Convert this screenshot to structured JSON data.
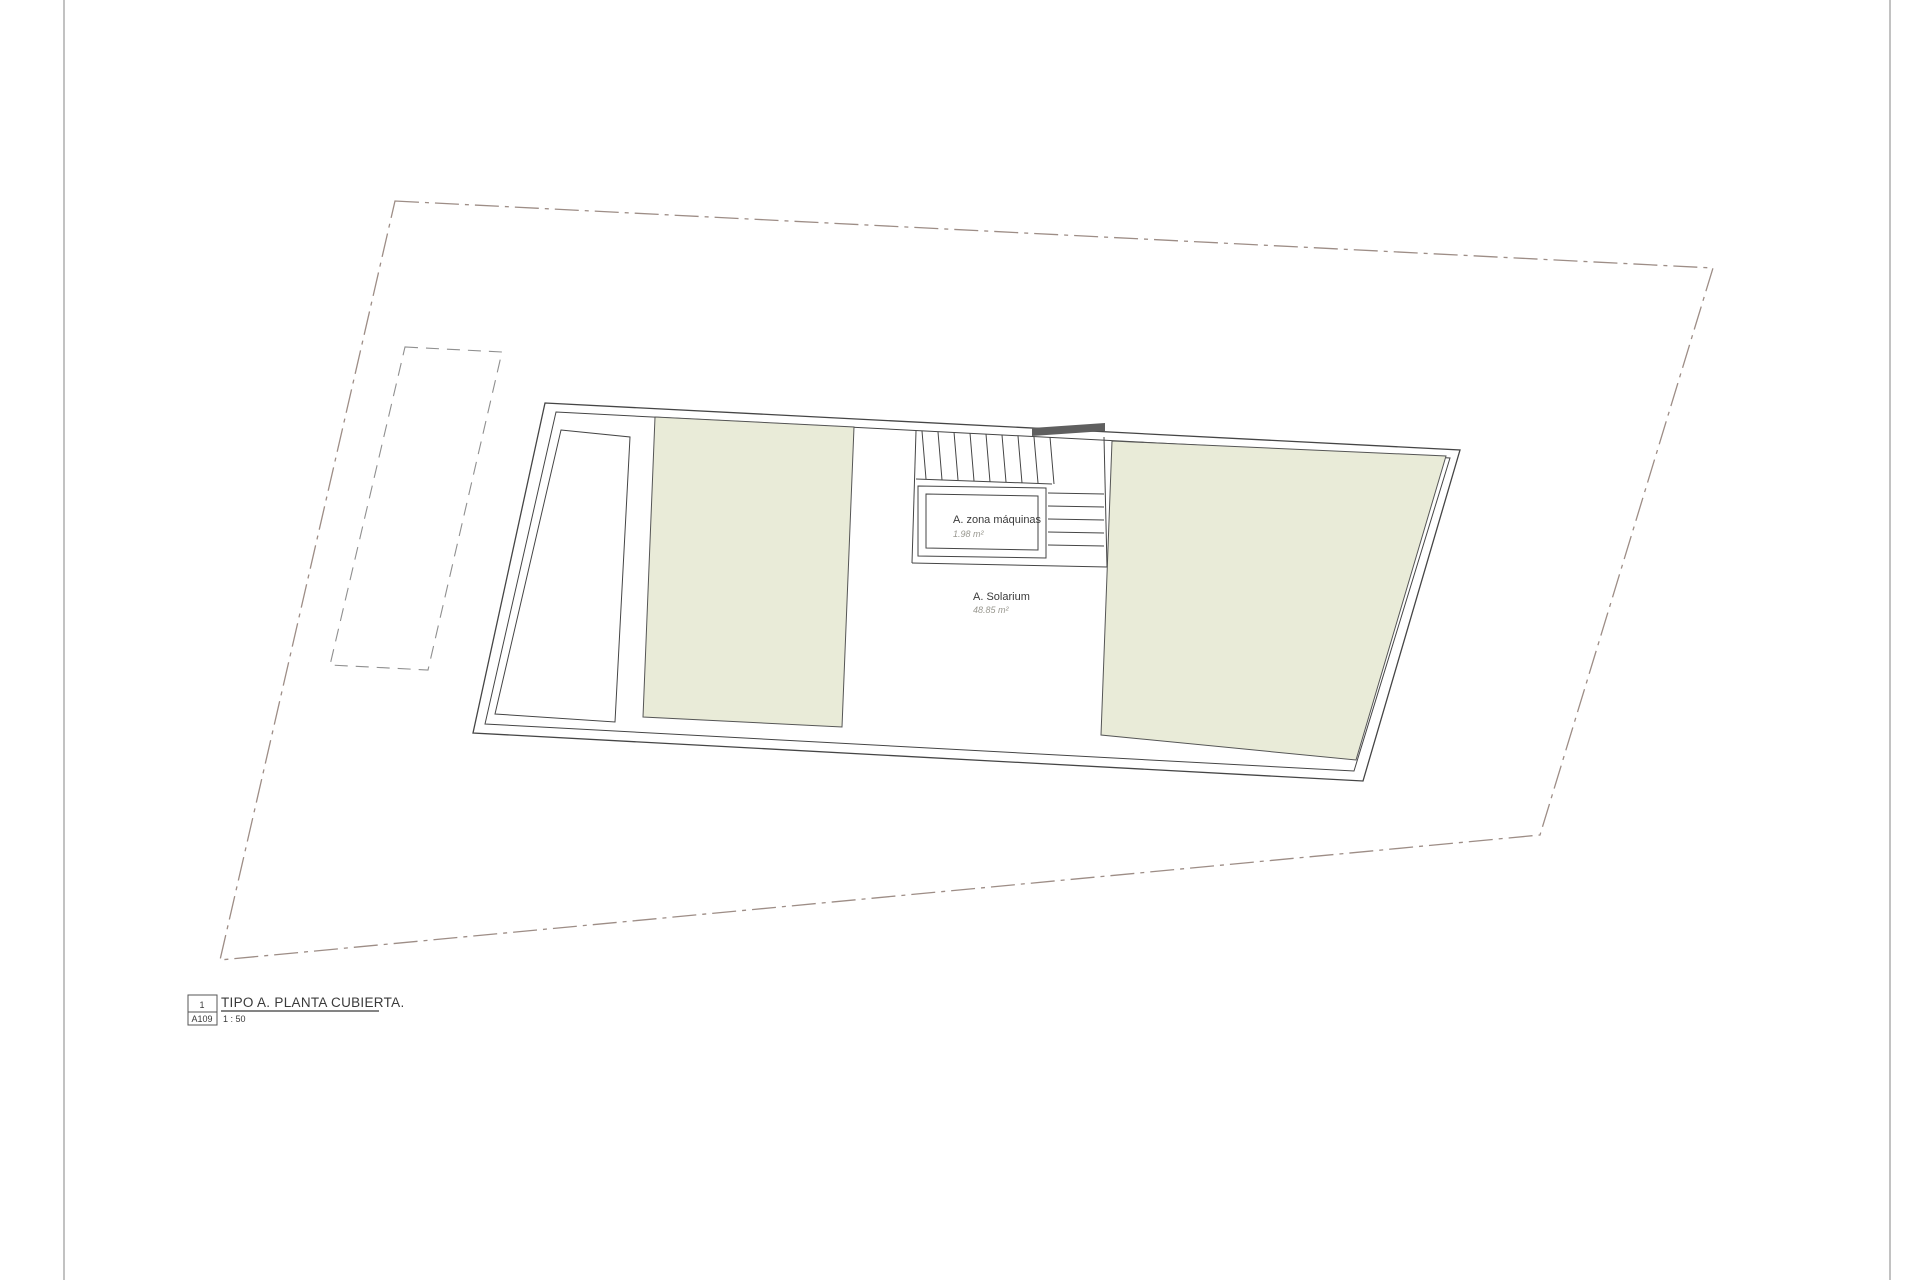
{
  "drawing": {
    "rooms": {
      "zona_maquinas": {
        "label": "A. zona máquinas",
        "area": "1.98 m²"
      },
      "solarium": {
        "label": "A. Solarium",
        "area": "48.85 m²"
      }
    },
    "title_block": {
      "detail_number": "1",
      "sheet_number": "A109",
      "title": "TIPO A. PLANTA CUBIERTA.",
      "scale": "1 : 50"
    },
    "colors": {
      "roof_terrace_fill": "#e9ebd8",
      "parcel_boundary_line": "#9d8d86",
      "wall_line": "#454545",
      "stair_landing_bar": "#5f5f5f",
      "sheet_border": "#b3b3b3"
    }
  }
}
